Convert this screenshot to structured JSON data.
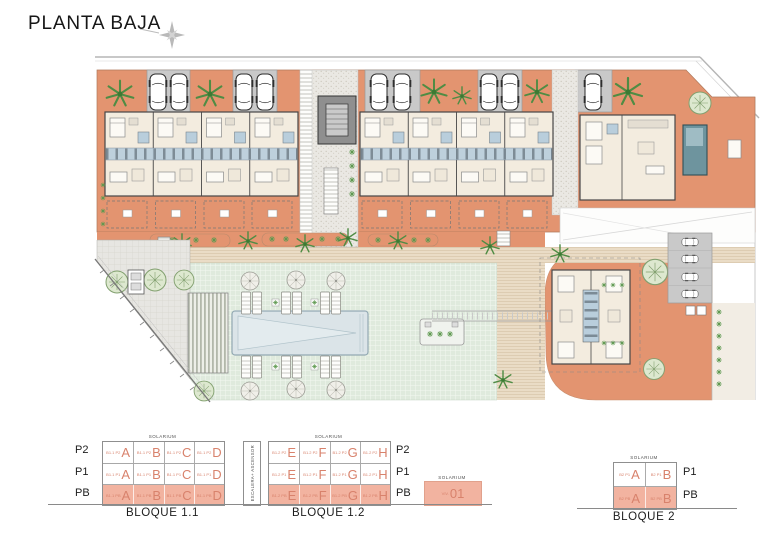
{
  "header": {
    "title": "PLANTA BAJA",
    "compass_icon": "north-compass-star"
  },
  "palette": {
    "terrace_salmon": "#E39470",
    "legend_pb_fill": "#F2B3A0",
    "legend_letter": "#D8826C",
    "communal_pool": "#DBE4E8",
    "private_pool": "#6E949E",
    "lawn_green": "#DFEADD",
    "parking_gray": "#C9C9C9"
  },
  "site_plan": {
    "features": [
      "parking-cars",
      "apartment-buildings",
      "central-stair-core",
      "promenade",
      "pergola",
      "communal-pool",
      "sun-loungers",
      "lawn",
      "detached-villa",
      "private-pool",
      "bloque-2-building",
      "boundary-lines",
      "trees"
    ]
  },
  "legend": {
    "escalera_label": "ESCALERA+ ASCENSOR",
    "viv01": {
      "solarium": "SOLARIUM",
      "prefix": "VIV.",
      "number": "01"
    },
    "blocks": [
      {
        "name": "BLOQUE 1.1",
        "solarium": "SOLARIUM",
        "side_labels": [
          "P2",
          "P1",
          "PB"
        ],
        "rows": [
          {
            "cells": [
              {
                "prefix": "B1.1 P2",
                "letter": "A"
              },
              {
                "prefix": "B1.1 P2",
                "letter": "B"
              },
              {
                "prefix": "B1.1 P2",
                "letter": "C"
              },
              {
                "prefix": "B1.1 P2",
                "letter": "D"
              }
            ]
          },
          {
            "cells": [
              {
                "prefix": "B1.1 P1",
                "letter": "A"
              },
              {
                "prefix": "B1.1 P1",
                "letter": "B"
              },
              {
                "prefix": "B1.1 P1",
                "letter": "C"
              },
              {
                "prefix": "B1.1 P1",
                "letter": "D"
              }
            ]
          },
          {
            "cells": [
              {
                "prefix": "B1.1 PB",
                "letter": "A"
              },
              {
                "prefix": "B1.1 PB",
                "letter": "B"
              },
              {
                "prefix": "B1.1 PB",
                "letter": "C"
              },
              {
                "prefix": "B1.1 PB",
                "letter": "D"
              }
            ]
          }
        ]
      },
      {
        "name": "BLOQUE 1.2",
        "solarium": "SOLARIUM",
        "side_labels": [
          "P2",
          "P1",
          "PB"
        ],
        "rows": [
          {
            "cells": [
              {
                "prefix": "B1.2 P2",
                "letter": "E"
              },
              {
                "prefix": "B1.2 P2",
                "letter": "F"
              },
              {
                "prefix": "B1.2 P2",
                "letter": "G"
              },
              {
                "prefix": "B1.2 P2",
                "letter": "H"
              }
            ]
          },
          {
            "cells": [
              {
                "prefix": "B1.2 P1",
                "letter": "E"
              },
              {
                "prefix": "B1.2 P1",
                "letter": "F"
              },
              {
                "prefix": "B1.2 P1",
                "letter": "G"
              },
              {
                "prefix": "B1.2 P1",
                "letter": "H"
              }
            ]
          },
          {
            "cells": [
              {
                "prefix": "B1.2 PB",
                "letter": "E"
              },
              {
                "prefix": "B1.2 PB",
                "letter": "F"
              },
              {
                "prefix": "B1.2 PB",
                "letter": "G"
              },
              {
                "prefix": "B1.2 PB",
                "letter": "H"
              }
            ]
          }
        ]
      },
      {
        "name": "BLOQUE 2",
        "solarium": "SOLARIUM",
        "side_labels": [
          "P1",
          "PB"
        ],
        "rows": [
          {
            "cells": [
              {
                "prefix": "B2 P1",
                "letter": "A"
              },
              {
                "prefix": "B2 P1",
                "letter": "B"
              }
            ]
          },
          {
            "cells": [
              {
                "prefix": "B2 PB",
                "letter": "A"
              },
              {
                "prefix": "B2 PB",
                "letter": "B"
              }
            ]
          }
        ]
      }
    ]
  }
}
